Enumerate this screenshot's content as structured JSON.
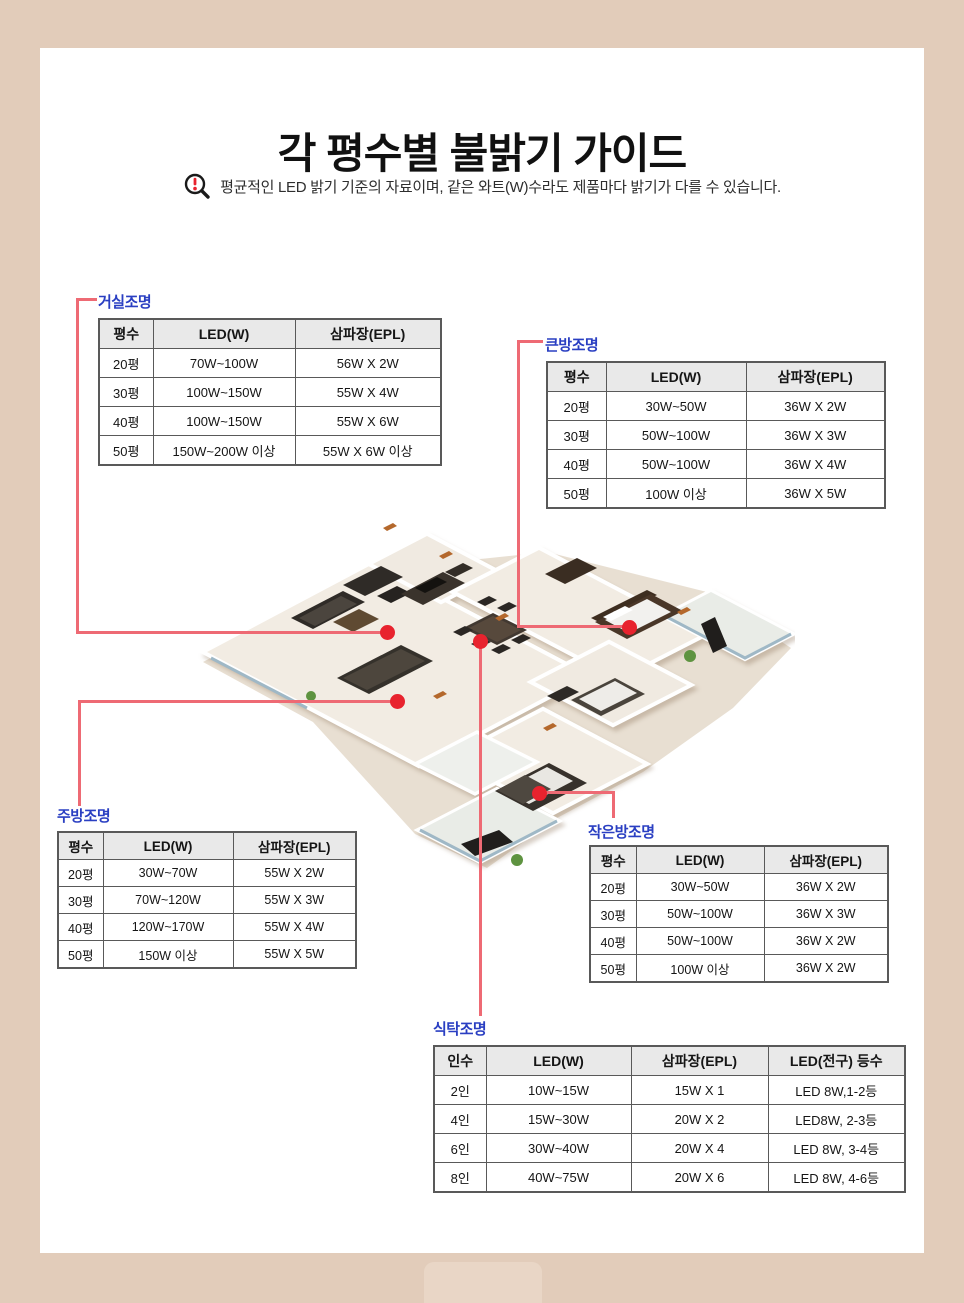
{
  "page": {
    "title": "각 평수별 불밝기 가이드",
    "notice": "평균적인 LED 밝기 기준의 자료이며, 같은 와트(W)수라도 제품마다 밝기가 다를 수 있습니다."
  },
  "colors": {
    "frame_beige": "#e2ccba",
    "label_blue": "#2a3fc2",
    "marker_red": "#e8232e",
    "connector_red": "#ee6a74",
    "table_header_gray": "#e9e9e9",
    "table_border_gray": "#595959"
  },
  "floorplan": {
    "markers": [
      "living-room",
      "dining-table",
      "kitchen",
      "master-room",
      "small-room"
    ]
  },
  "tables": {
    "living": {
      "label": "거실조명",
      "headers": [
        "평수",
        "LED(W)",
        "삼파장(EPL)"
      ],
      "rows": [
        [
          "20평",
          "70W~100W",
          "56W X 2W"
        ],
        [
          "30평",
          "100W~150W",
          "55W X 4W"
        ],
        [
          "40평",
          "100W~150W",
          "55W X 6W"
        ],
        [
          "50평",
          "150W~200W 이상",
          "55W X 6W 이상"
        ]
      ]
    },
    "big_room": {
      "label": "큰방조명",
      "headers": [
        "평수",
        "LED(W)",
        "삼파장(EPL)"
      ],
      "rows": [
        [
          "20평",
          "30W~50W",
          "36W X 2W"
        ],
        [
          "30평",
          "50W~100W",
          "36W X 3W"
        ],
        [
          "40평",
          "50W~100W",
          "36W X 4W"
        ],
        [
          "50평",
          "100W 이상",
          "36W X 5W"
        ]
      ]
    },
    "kitchen": {
      "label": "주방조명",
      "headers": [
        "평수",
        "LED(W)",
        "삼파장(EPL)"
      ],
      "rows": [
        [
          "20평",
          "30W~70W",
          "55W X 2W"
        ],
        [
          "30평",
          "70W~120W",
          "55W X 3W"
        ],
        [
          "40평",
          "120W~170W",
          "55W X 4W"
        ],
        [
          "50평",
          "150W 이상",
          "55W X 5W"
        ]
      ]
    },
    "small_room": {
      "label": "작은방조명",
      "headers": [
        "평수",
        "LED(W)",
        "삼파장(EPL)"
      ],
      "rows": [
        [
          "20평",
          "30W~50W",
          "36W X 2W"
        ],
        [
          "30평",
          "50W~100W",
          "36W X 3W"
        ],
        [
          "40평",
          "50W~100W",
          "36W X 2W"
        ],
        [
          "50평",
          "100W 이상",
          "36W X 2W"
        ]
      ]
    },
    "dining": {
      "label": "식탁조명",
      "headers": [
        "인수",
        "LED(W)",
        "삼파장(EPL)",
        "LED(전구) 등수"
      ],
      "rows": [
        [
          "2인",
          "10W~15W",
          "15W X 1",
          "LED 8W,1-2등"
        ],
        [
          "4인",
          "15W~30W",
          "20W X 2",
          "LED8W, 2-3등"
        ],
        [
          "6인",
          "30W~40W",
          "20W X 4",
          "LED 8W, 3-4등"
        ],
        [
          "8인",
          "40W~75W",
          "20W X 6",
          "LED 8W, 4-6등"
        ]
      ]
    }
  }
}
